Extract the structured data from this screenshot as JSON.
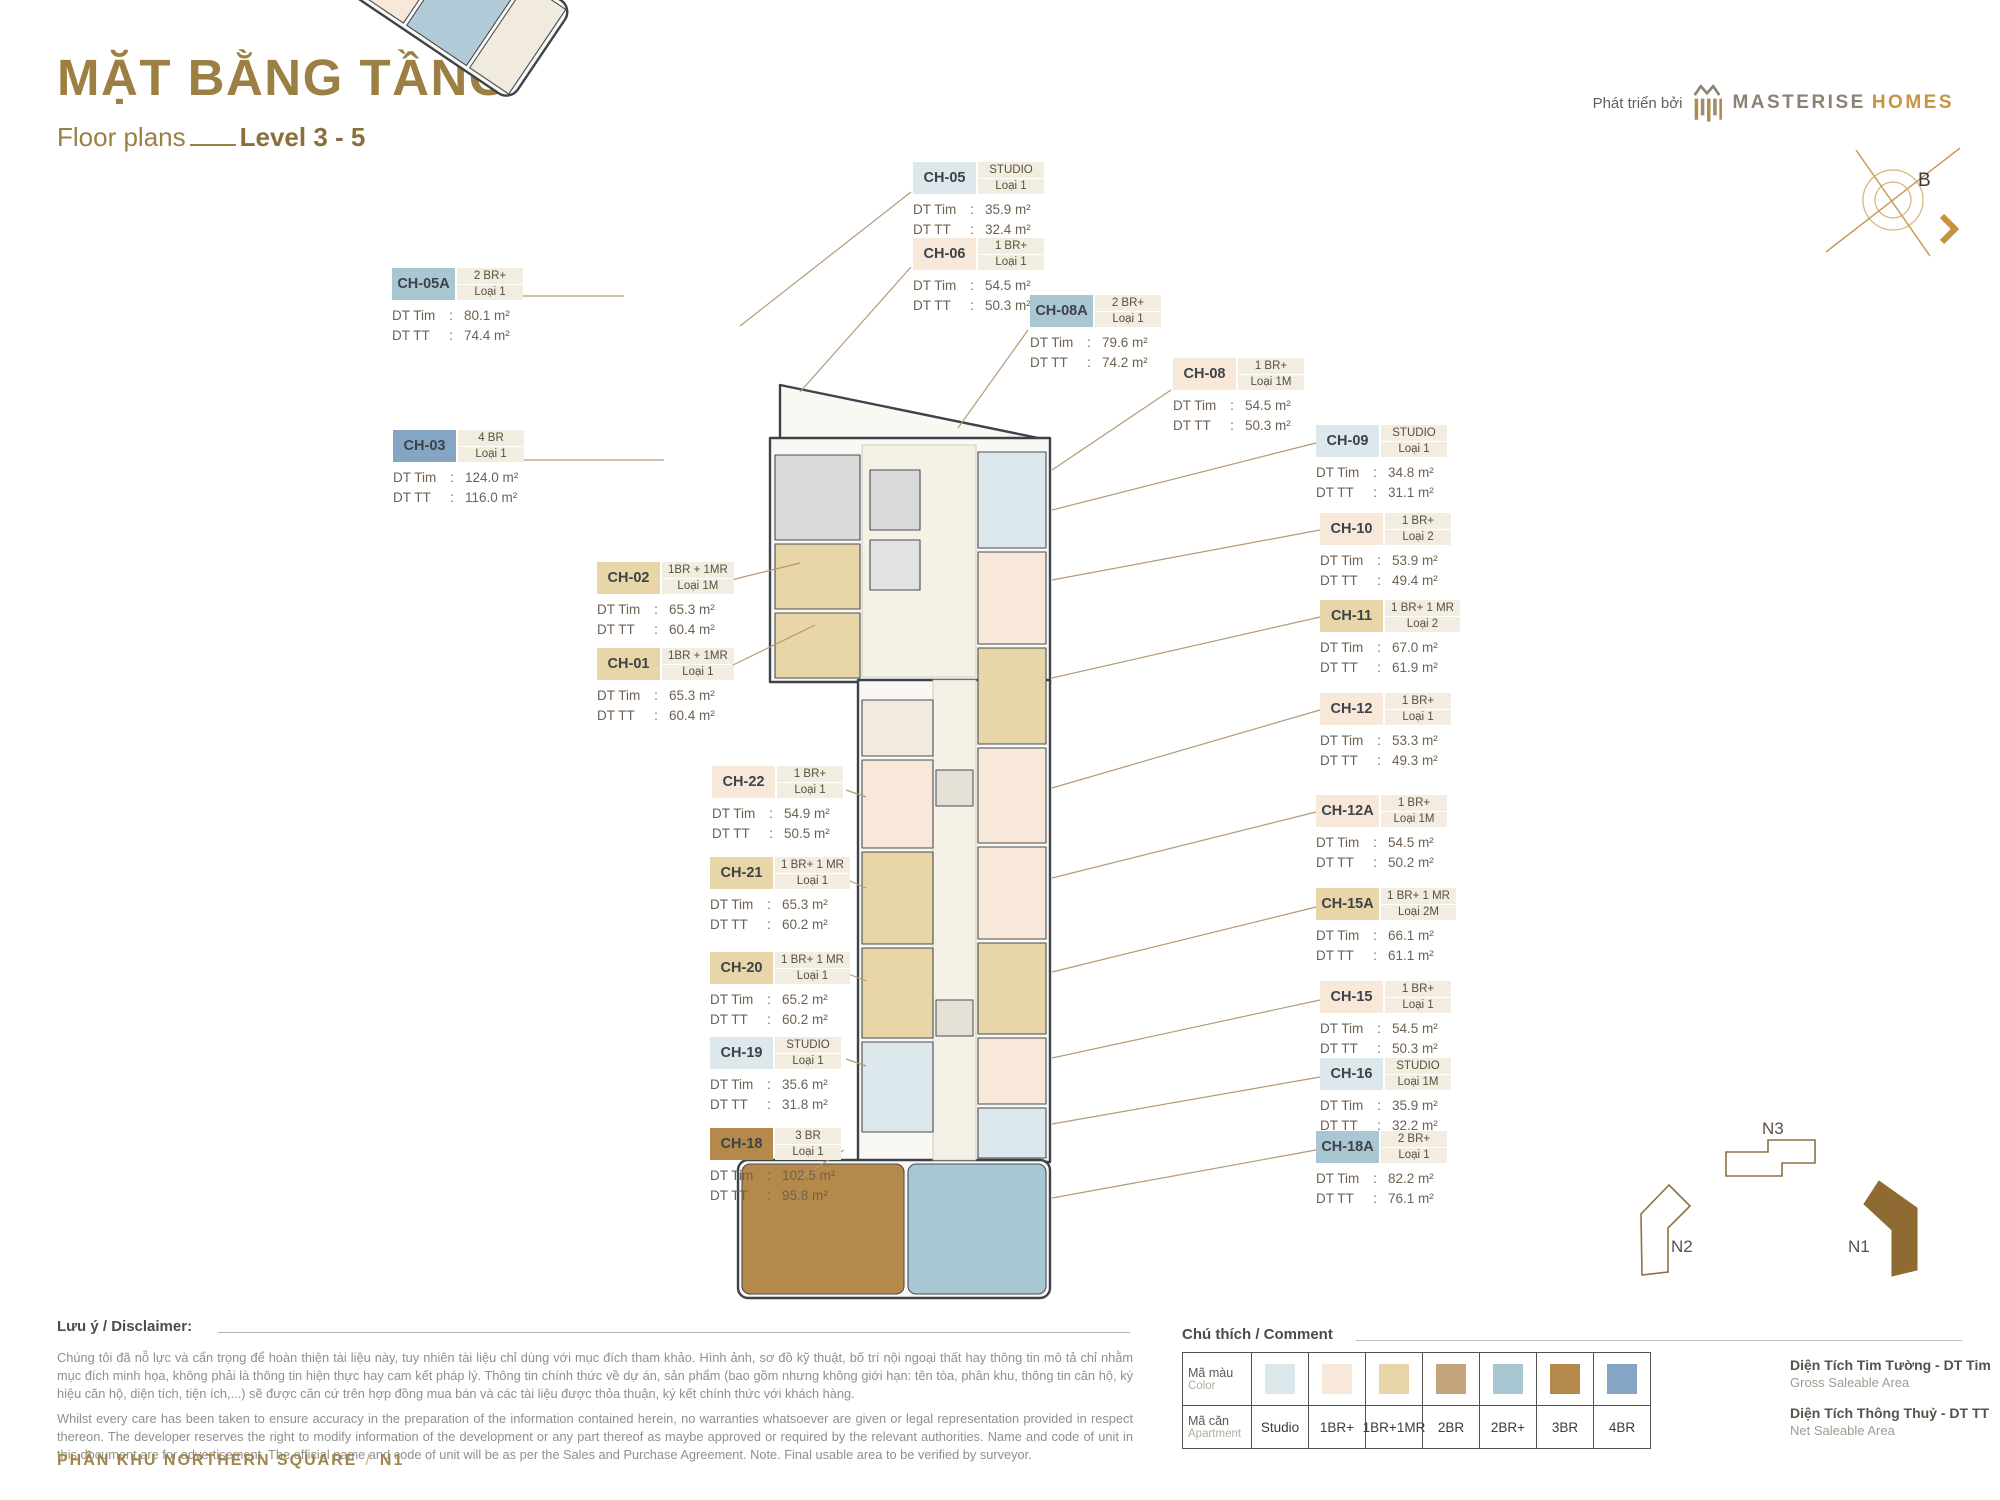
{
  "header": {
    "title": "MẶT BẰNG TẦNG",
    "subtitle": "Floor plans",
    "level": "Level 3 - 5",
    "developer_prefix": "Phát triển bởi",
    "brand_name": "MASTERISE",
    "brand_suffix": "HOMES",
    "compass_label": "B"
  },
  "labels": {
    "dt_tim": "DT Tim",
    "dt_tt": "DT TT"
  },
  "colors": {
    "studio": "#dce8eb",
    "br1": "#f7e8d9",
    "br1mr": "#e8d5a8",
    "br2": "#c3a47b",
    "br2p": "#a9c6d3",
    "br3": "#b5894a",
    "br4": "#84a6c4"
  },
  "units": [
    {
      "code": "CH-05A",
      "type": "2 BR+",
      "loai": "Loại 1",
      "dt_tim": "80.1 m²",
      "dt_tt": "74.4 m²",
      "color_key": "br2p",
      "x": 392,
      "y": 268
    },
    {
      "code": "CH-03",
      "type": "4 BR",
      "loai": "Loại 1",
      "dt_tim": "124.0 m²",
      "dt_tt": "116.0 m²",
      "color_key": "br4",
      "x": 393,
      "y": 430
    },
    {
      "code": "CH-02",
      "type": "1BR + 1MR",
      "loai": "Loại 1M",
      "dt_tim": "65.3 m²",
      "dt_tt": "60.4 m²",
      "color_key": "br1mr",
      "x": 597,
      "y": 562
    },
    {
      "code": "CH-01",
      "type": "1BR + 1MR",
      "loai": "Loại 1",
      "dt_tim": "65.3 m²",
      "dt_tt": "60.4 m²",
      "color_key": "br1mr",
      "x": 597,
      "y": 648
    },
    {
      "code": "CH-22",
      "type": "1 BR+",
      "loai": "Loại 1",
      "dt_tim": "54.9 m²",
      "dt_tt": "50.5 m²",
      "color_key": "br1",
      "x": 712,
      "y": 766
    },
    {
      "code": "CH-21",
      "type": "1 BR+ 1 MR",
      "loai": "Loại 1",
      "dt_tim": "65.3 m²",
      "dt_tt": "60.2 m²",
      "color_key": "br1mr",
      "x": 710,
      "y": 857
    },
    {
      "code": "CH-20",
      "type": "1 BR+ 1 MR",
      "loai": "Loại 1",
      "dt_tim": "65.2 m²",
      "dt_tt": "60.2 m²",
      "color_key": "br1mr",
      "x": 710,
      "y": 952
    },
    {
      "code": "CH-19",
      "type": "STUDIO",
      "loai": "Loại 1",
      "dt_tim": "35.6 m²",
      "dt_tt": "31.8 m²",
      "color_key": "studio",
      "x": 710,
      "y": 1037
    },
    {
      "code": "CH-18",
      "type": "3 BR",
      "loai": "Loại 1",
      "dt_tim": "102.5 m²",
      "dt_tt": "95.8 m²",
      "color_key": "br3",
      "x": 710,
      "y": 1128
    },
    {
      "code": "CH-05",
      "type": "STUDIO",
      "loai": "Loại 1",
      "dt_tim": "35.9 m²",
      "dt_tt": "32.4 m²",
      "color_key": "studio",
      "x": 913,
      "y": 162
    },
    {
      "code": "CH-06",
      "type": "1 BR+",
      "loai": "Loại 1",
      "dt_tim": "54.5 m²",
      "dt_tt": "50.3 m²",
      "color_key": "br1",
      "x": 913,
      "y": 238
    },
    {
      "code": "CH-08A",
      "type": "2 BR+",
      "loai": "Loại 1",
      "dt_tim": "79.6 m²",
      "dt_tt": "74.2 m²",
      "color_key": "br2p",
      "x": 1030,
      "y": 295
    },
    {
      "code": "CH-08",
      "type": "1 BR+",
      "loai": "Loại 1M",
      "dt_tim": "54.5 m²",
      "dt_tt": "50.3 m²",
      "color_key": "br1",
      "x": 1173,
      "y": 358
    },
    {
      "code": "CH-09",
      "type": "STUDIO",
      "loai": "Loại 1",
      "dt_tim": "34.8 m²",
      "dt_tt": "31.1 m²",
      "color_key": "studio",
      "x": 1316,
      "y": 425
    },
    {
      "code": "CH-10",
      "type": "1 BR+",
      "loai": "Loại 2",
      "dt_tim": "53.9 m²",
      "dt_tt": "49.4 m²",
      "color_key": "br1",
      "x": 1320,
      "y": 513
    },
    {
      "code": "CH-11",
      "type": "1 BR+ 1 MR",
      "loai": "Loại 2",
      "dt_tim": "67.0 m²",
      "dt_tt": "61.9 m²",
      "color_key": "br1mr",
      "x": 1320,
      "y": 600
    },
    {
      "code": "CH-12",
      "type": "1 BR+",
      "loai": "Loại 1",
      "dt_tim": "53.3 m²",
      "dt_tt": "49.3 m²",
      "color_key": "br1",
      "x": 1320,
      "y": 693
    },
    {
      "code": "CH-12A",
      "type": "1 BR+",
      "loai": "Loại 1M",
      "dt_tim": "54.5 m²",
      "dt_tt": "50.2 m²",
      "color_key": "br1",
      "x": 1316,
      "y": 795
    },
    {
      "code": "CH-15A",
      "type": "1 BR+ 1 MR",
      "loai": "Loại 2M",
      "dt_tim": "66.1 m²",
      "dt_tt": "61.1 m²",
      "color_key": "br1mr",
      "x": 1316,
      "y": 888
    },
    {
      "code": "CH-15",
      "type": "1 BR+",
      "loai": "Loại 1",
      "dt_tim": "54.5 m²",
      "dt_tt": "50.3 m²",
      "color_key": "br1",
      "x": 1320,
      "y": 981
    },
    {
      "code": "CH-16",
      "type": "STUDIO",
      "loai": "Loại 1M",
      "dt_tim": "35.9 m²",
      "dt_tt": "32.2 m²",
      "color_key": "studio",
      "x": 1320,
      "y": 1058
    },
    {
      "code": "CH-18A",
      "type": "2 BR+",
      "loai": "Loại 1",
      "dt_tim": "82.2 m²",
      "dt_tt": "76.1 m²",
      "color_key": "br2p",
      "x": 1316,
      "y": 1131
    }
  ],
  "legend": {
    "section_title": "Chú thích / Comment",
    "row_color_vn": "Mã màu",
    "row_color_en": "Color",
    "row_apt_vn": "Mã căn",
    "row_apt_en": "Apartment",
    "types": [
      {
        "label": "Studio",
        "color_key": "studio"
      },
      {
        "label": "1BR+",
        "color_key": "br1"
      },
      {
        "label": "1BR+1MR",
        "color_key": "br1mr"
      },
      {
        "label": "2BR",
        "color_key": "br2"
      },
      {
        "label": "2BR+",
        "color_key": "br2p"
      },
      {
        "label": "3BR",
        "color_key": "br3"
      },
      {
        "label": "4BR",
        "color_key": "br4"
      }
    ]
  },
  "area_defs": [
    {
      "vn": "Diện Tích Tim Tường - DT Tim",
      "en": "Gross Saleable Area"
    },
    {
      "vn": "Diện Tích Thông Thuỷ - DT TT",
      "en": "Net Saleable Area"
    }
  ],
  "disclaimer": {
    "heading": "Lưu ý / Disclaimer:",
    "paragraph_vn": "Chúng tôi đã nỗ lực và cẩn trọng để hoàn thiện tài liệu này, tuy nhiên tài liệu chỉ dùng với mục đích tham khảo. Hình ảnh, sơ đồ kỹ thuật, bố trí nội ngoại thất hay thông tin mô tả chỉ nhằm mục đích minh họa, không phải là thông tin hiện thực hay cam kết pháp lý. Thông tin chính thức về dự án, sản phẩm (bao gồm nhưng không giới hạn: tên tòa, phân khu, thông tin căn hộ, ký hiệu căn hộ, diện tích, tiện ích,...) sẽ được căn cứ trên hợp đồng mua bán và các tài liệu được thỏa thuận, ký kết chính thức với khách hàng.",
    "paragraph_en": "Whilst every care has been taken to ensure accuracy in the preparation of the information contained herein, no warranties whatsoever are given or legal representation provided in respect thereon. The developer reserves the right to modify information of the development or any part thereof as maybe approved or required by the relevant authorities. Name and code of unit in this document are for advertisement. The official name and code of unit will be as per the Sales and Purchase Agreement. Note. Final usable area to be verified by surveyor."
  },
  "footer": {
    "zone_label": "PHÂN KHU NORTHERN SQUARE",
    "separator": "/",
    "block": "N1"
  },
  "minimap": {
    "n1": "N1",
    "n2": "N2",
    "n3": "N3"
  }
}
